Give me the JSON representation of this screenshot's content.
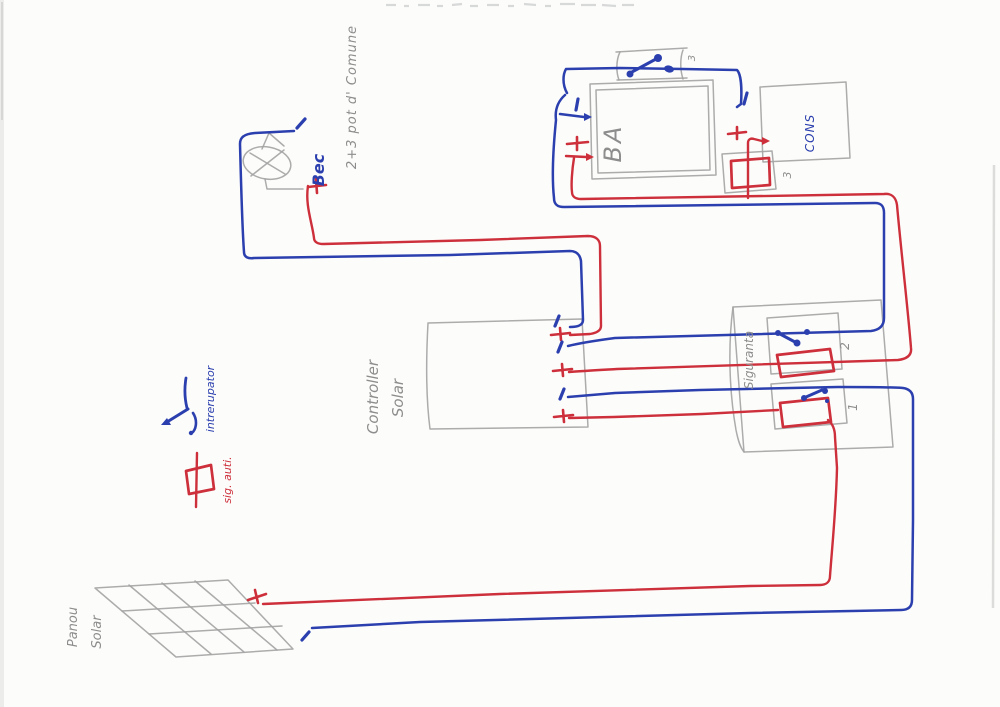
{
  "diagram": {
    "kind": "hand-drawn solar wiring schematic (scanned page)",
    "wire_colors": {
      "positive": "#cd2f3b",
      "negative": "#2b3fae",
      "pencil": "#a3a3a3"
    }
  },
  "labels": {
    "bec": "Bec",
    "note": "2+3 pot d' Comune",
    "battery": "BA",
    "consumer": "CONS",
    "switch3": "3",
    "fuse3": "3",
    "fusebox": "Siguranta",
    "circuit2": "2",
    "circuit1": "1",
    "controller1": "Controller",
    "controller2": "Solar",
    "legend_switch": "intrerupator",
    "legend_fuse": "sig. auti.",
    "panel1": "Panou",
    "panel2": "Solar"
  }
}
